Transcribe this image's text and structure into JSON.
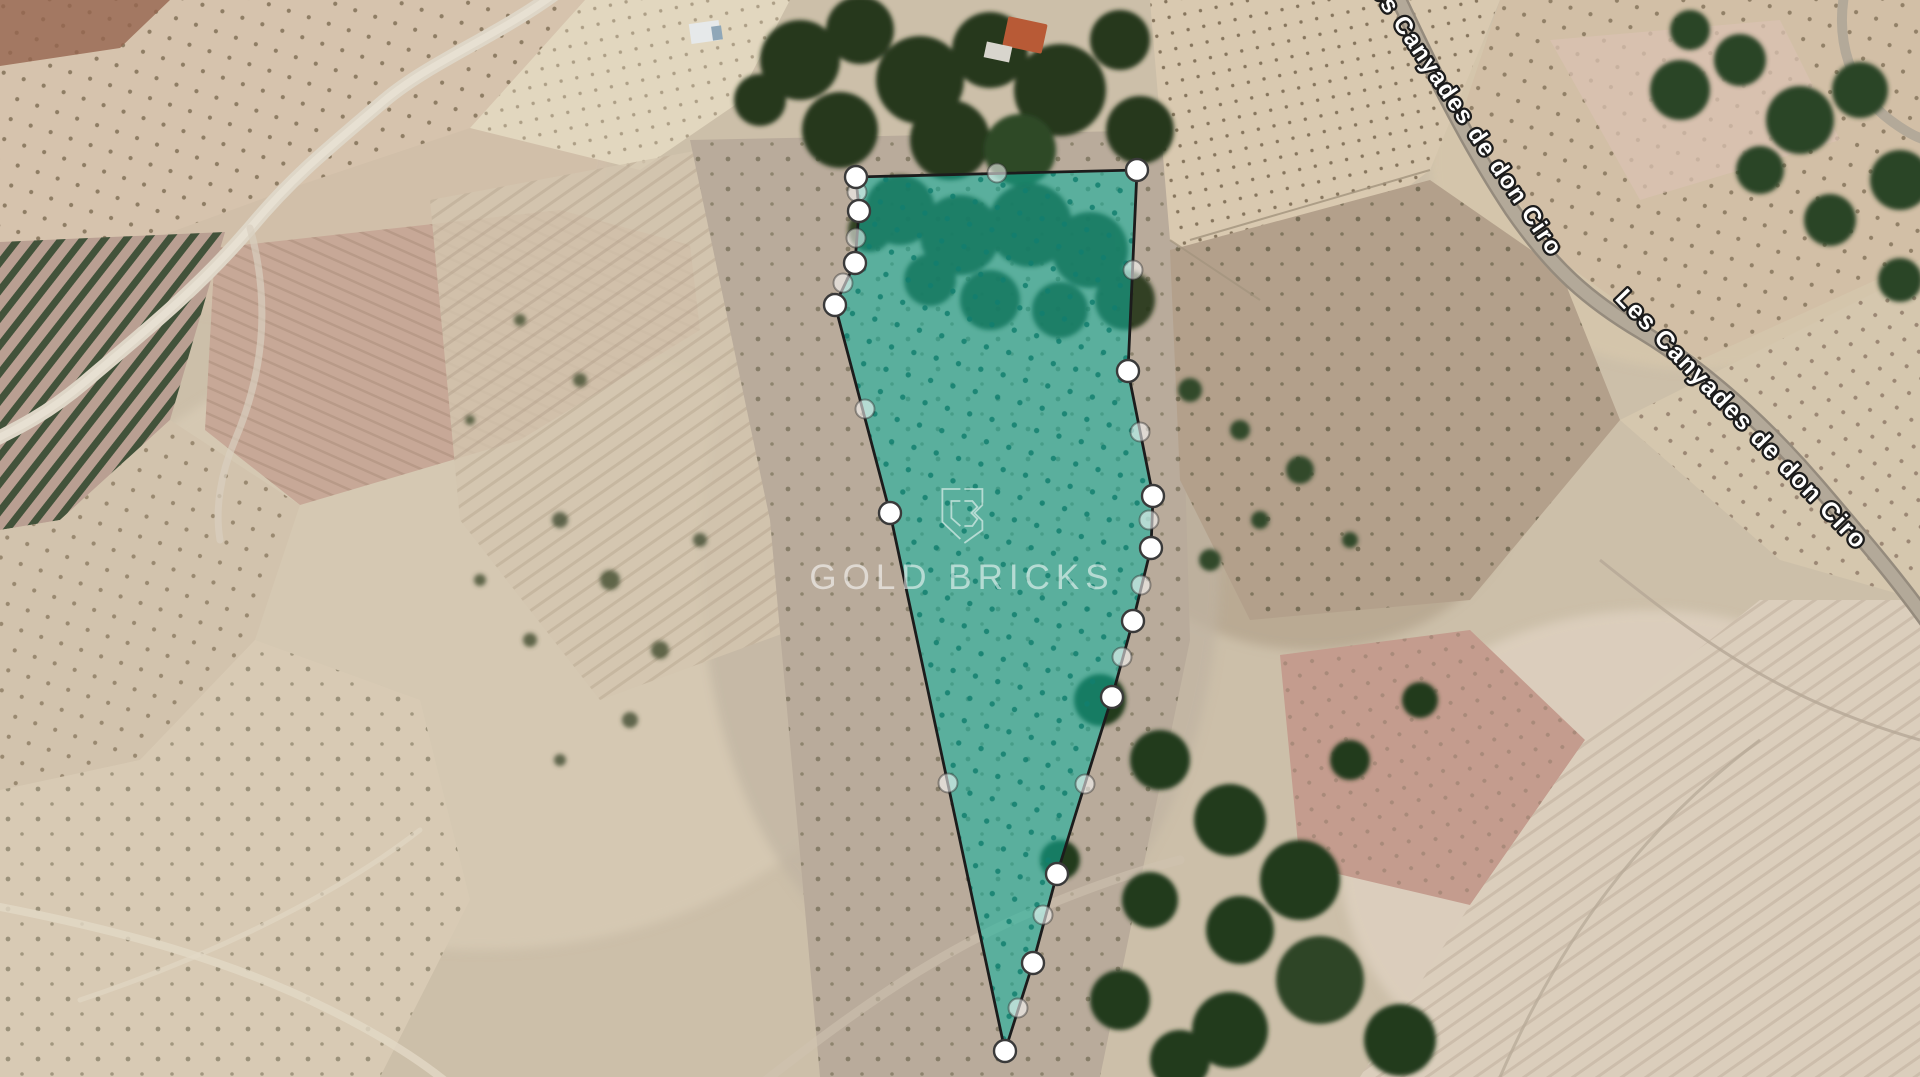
{
  "map": {
    "view": "satellite",
    "road_labels": [
      {
        "id": "road-label-top",
        "text": "Les Canyades de don Ciro"
      },
      {
        "id": "road-label-lower",
        "text": "Les Canyades de don Ciro"
      }
    ],
    "label_style": {
      "fill": "#ffffff",
      "outline": "#1c1c1c"
    }
  },
  "watermark": {
    "brand": "GOLD BRICKS",
    "logo": "gold-bricks-monogram-shield",
    "color": "rgba(255,255,255,0.55)"
  },
  "parcel": {
    "shape": "polygon",
    "fill_color": "#0db39e",
    "fill_opacity": 0.55,
    "stroke_color": "#1c1c1c",
    "vertex_count": 14,
    "vertices": [
      [
        856,
        177
      ],
      [
        1137,
        170
      ],
      [
        1128,
        371
      ],
      [
        1153,
        496
      ],
      [
        1151,
        548
      ],
      [
        1133,
        621
      ],
      [
        1112,
        697
      ],
      [
        1057,
        874
      ],
      [
        1033,
        963
      ],
      [
        1005,
        1051
      ],
      [
        890,
        513
      ],
      [
        835,
        305
      ],
      [
        855,
        263
      ],
      [
        859,
        211
      ]
    ],
    "midpoints": [
      [
        997,
        173
      ],
      [
        1133,
        270
      ],
      [
        1140,
        432
      ],
      [
        1149,
        520
      ],
      [
        1141,
        585
      ],
      [
        1122,
        657
      ],
      [
        1085,
        784
      ],
      [
        1043,
        915
      ],
      [
        1018,
        1008
      ],
      [
        948,
        783
      ],
      [
        865,
        409
      ],
      [
        843,
        283
      ],
      [
        856,
        238
      ],
      [
        857,
        192
      ]
    ],
    "vertex_style": {
      "fill": "#ffffff",
      "stroke": "#3a3a3a"
    },
    "midpoint_style": {
      "fill": "rgba(255,255,255,0.55)",
      "stroke": "rgba(50,50,50,0.45)"
    }
  }
}
